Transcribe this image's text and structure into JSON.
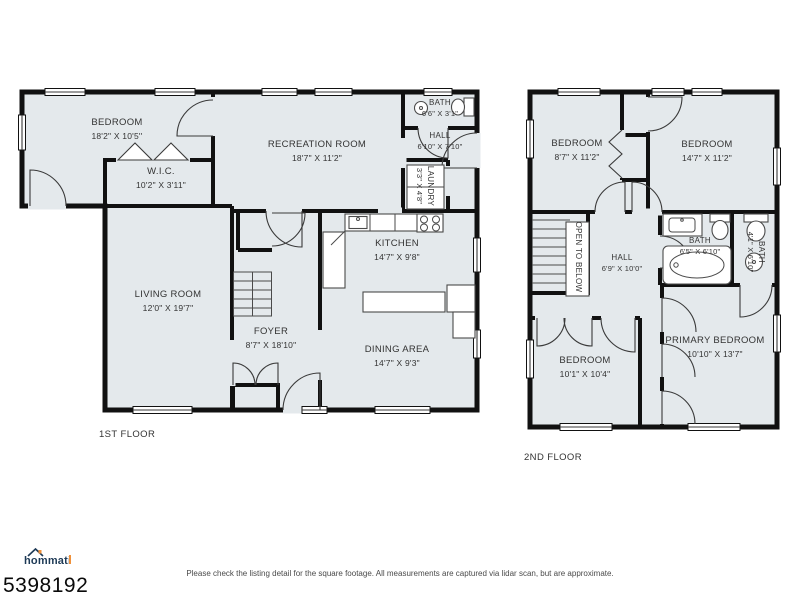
{
  "floors": [
    {
      "title": "1ST FLOOR",
      "rooms": [
        {
          "name": "BEDROOM",
          "dims": "18'2\" X 10'5''"
        },
        {
          "name": "W.I.C.",
          "dims": "10'2\" X 3'11\""
        },
        {
          "name": "RECREATION ROOM",
          "dims": "18'7\" X 11'2\""
        },
        {
          "name": "BATH",
          "dims": "6'6\" X 3'1\""
        },
        {
          "name": "HALL",
          "dims": "6'10\" X 7'10\""
        },
        {
          "name": "LAUNDRY",
          "dims": "3'3\" X 4'8\""
        },
        {
          "name": "LIVING ROOM",
          "dims": "12'0\" X 19'7\""
        },
        {
          "name": "FOYER",
          "dims": "8'7\" X 18'10\""
        },
        {
          "name": "KITCHEN",
          "dims": "14'7\" X 9'8\""
        },
        {
          "name": "DINING AREA",
          "dims": "14'7\" X 9'3\""
        }
      ]
    },
    {
      "title": "2ND FLOOR",
      "rooms": [
        {
          "name": "BEDROOM",
          "dims": "8'7\" X 11'2\""
        },
        {
          "name": "BEDROOM",
          "dims": "14'7\" X 11'2\""
        },
        {
          "name": "OPEN TO BELOW",
          "dims": ""
        },
        {
          "name": "HALL",
          "dims": "6'9\" X 10'0\""
        },
        {
          "name": "BATH",
          "dims": "6'5\" X 6'10\""
        },
        {
          "name": "BATH",
          "dims": "4'1\" X 6'10\""
        },
        {
          "name": "BEDROOM",
          "dims": "10'1\" X 10'4\""
        },
        {
          "name": "PRIMARY BEDROOM",
          "dims": "10'10\" X 13'7\""
        }
      ]
    }
  ],
  "footer": {
    "logo_text": "hommati",
    "listing_id": "5398192",
    "disclaimer": "Please check the listing detail for the square footage. All measurements are captured via lidar scan, but are approximate."
  },
  "colors": {
    "floor_fill": "#e4e9ec",
    "wall": "#111111",
    "logo_navy": "#1e3a56",
    "logo_orange": "#f0913a"
  }
}
